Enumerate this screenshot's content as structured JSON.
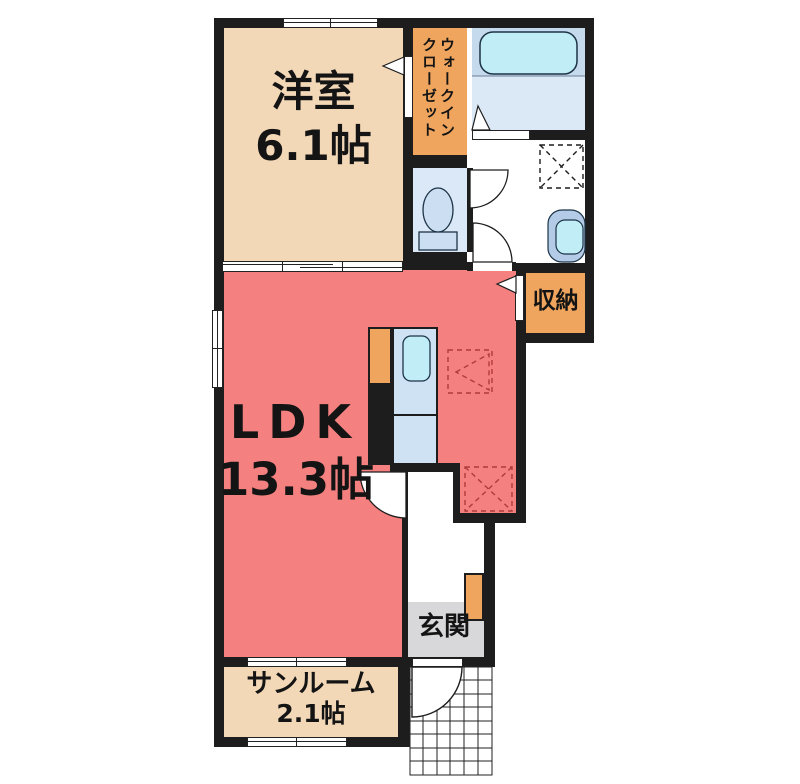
{
  "plan_title": "1LDK apartment floor plan",
  "rooms": {
    "western_room": {
      "name": "洋室",
      "size": "6.1帖"
    },
    "walk_in_closet": {
      "lines": [
        "ウォークイン",
        "クローゼット"
      ]
    },
    "ldk": {
      "name": "LDK",
      "size": "13.3帖"
    },
    "storage": {
      "name": "収納"
    },
    "entrance": {
      "name": "玄関"
    },
    "sunroom": {
      "name": "サンルーム",
      "size": "2.1帖"
    }
  },
  "colors": {
    "wall": "#1d1d1d",
    "room_tan": "#f3d8b8",
    "room_orange": "#f0a55e",
    "room_red": "#f4807f",
    "toilet_blue": "#dbe8f8",
    "bath_upper": "#c6daee",
    "bath_lower": "#dbe9f6",
    "fixture_cyan": "#c0edf6",
    "counter_blue": "#cfe2f4",
    "basin_outer": "#b3cbe7",
    "genkan_gray": "#d8d8db",
    "dash_red": "#b23b3b"
  }
}
